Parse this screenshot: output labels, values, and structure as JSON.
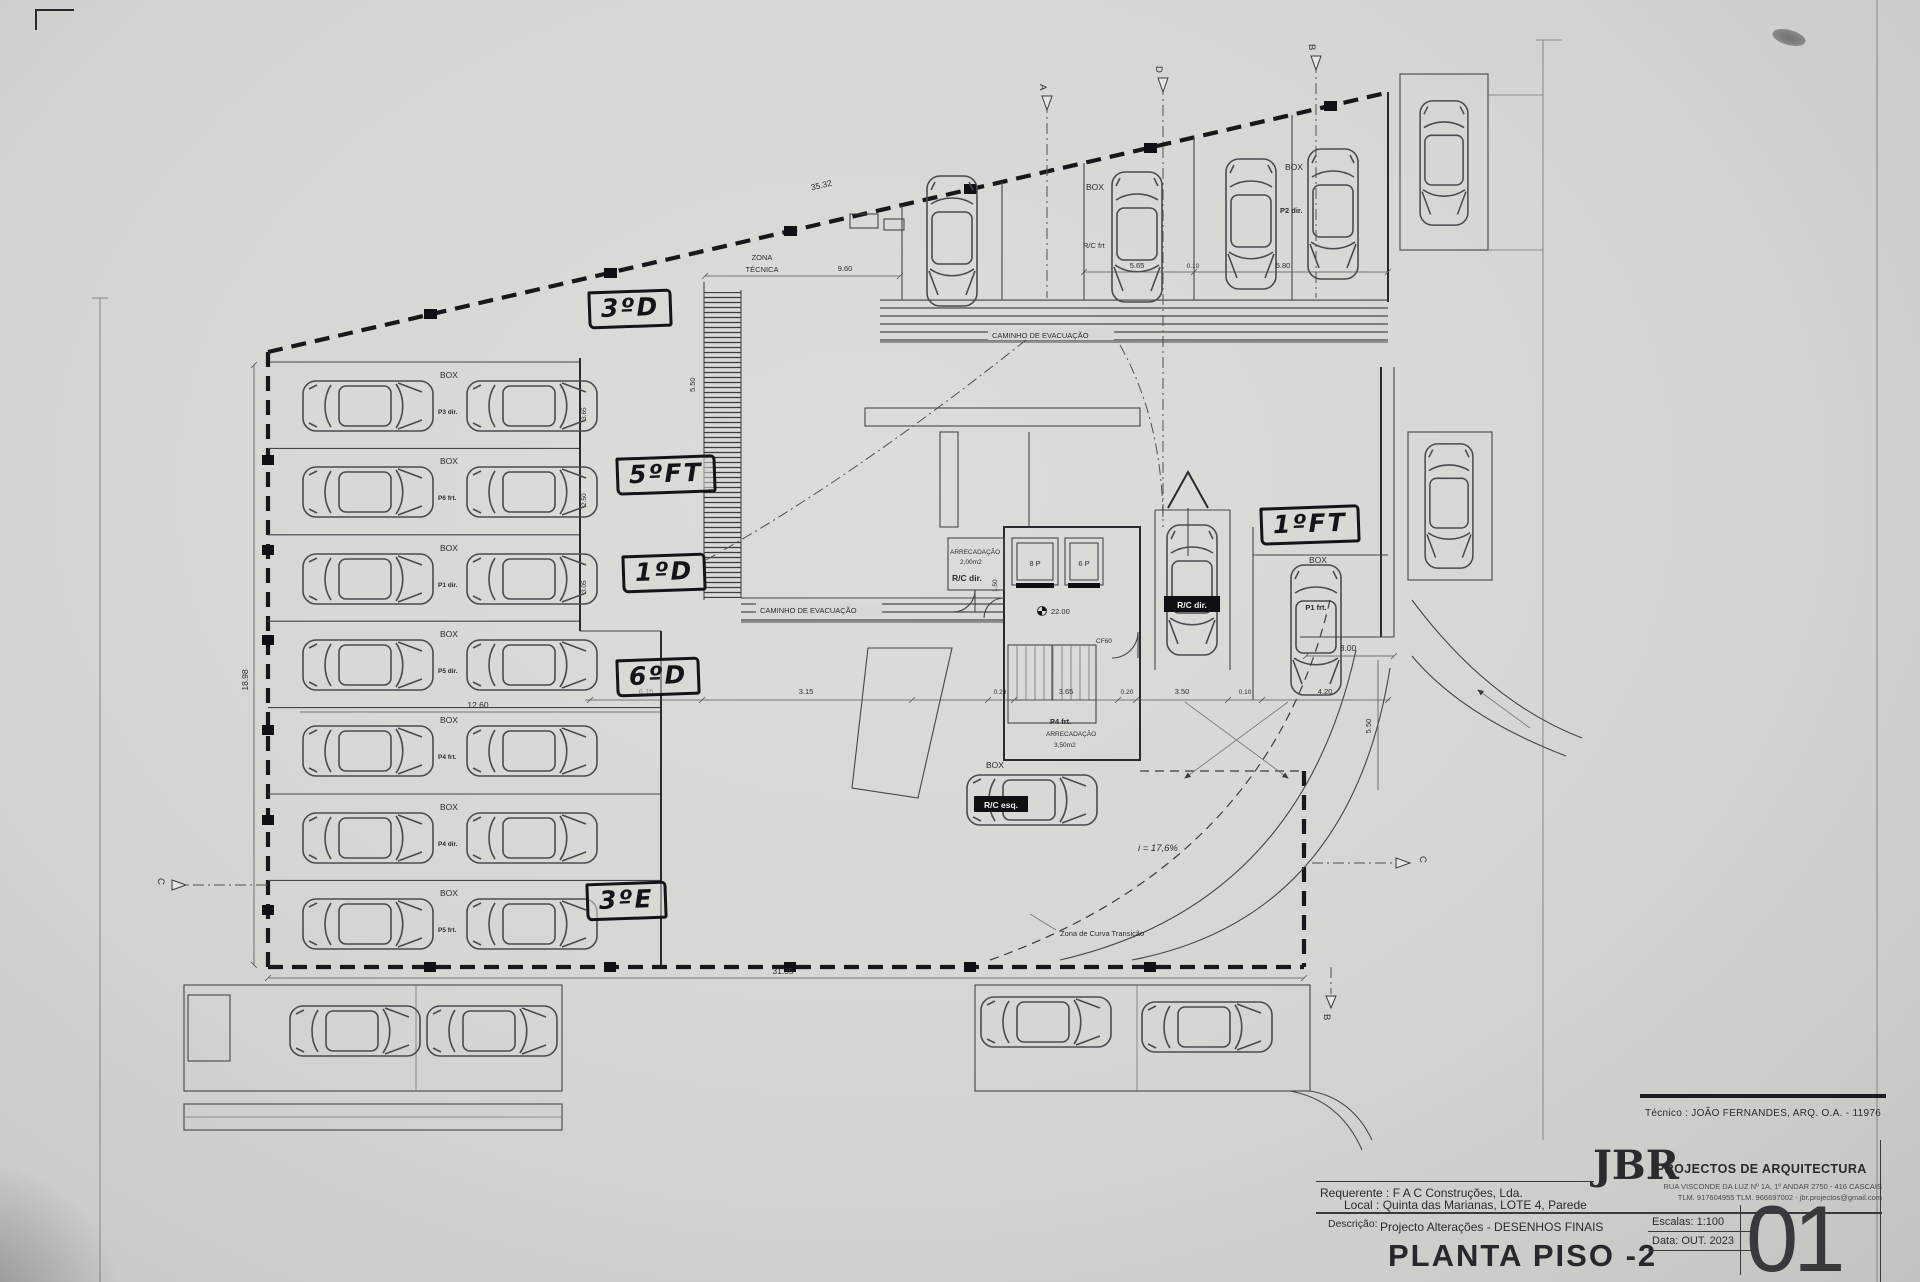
{
  "colors": {
    "paper": "#d9d8d5",
    "ink": "#2c2c30",
    "hand_ink": "#141418"
  },
  "title_block": {
    "tecnico": "Técnico : JOÃO FERNANDES, ARQ.  O.A. - 11976",
    "requerente": "Requerente : F A C  Construções, Lda.",
    "local": "Local : Quinta das Marianas, LOTE 4, Parede",
    "descricao_label": "Descrição:",
    "descricao": "Projecto Alterações - DESENHOS FINAIS",
    "drawing_title": "PLANTA PISO -2",
    "firm_initials": "JBR",
    "firm_name": "PROJECTOS DE ARQUITECTURA",
    "firm_address": "RUA VISCONDE DA LUZ Nº 1A, 1º ANDAR  2750 - 416  CASCAIS",
    "firm_contacts": "TLM. 917604955  TLM. 966697002 - jbr.projectos@gmail.com",
    "escala_label": "Escalas:  1:100",
    "data_label": "Data: OUT.  2023",
    "sheet_number": "01"
  },
  "handwritten": {
    "hw1": "3ºD",
    "hw2": "5ºFT",
    "hw3": "1ºD",
    "hw4": "6ºD",
    "hw5": "3ºE",
    "hw6": "1ºFT"
  },
  "labels": {
    "box": "BOX",
    "zona_tecnica_1": "ZONA",
    "zona_tecnica_2": "TÉCNICA",
    "caminho_evacuacao": "CAMINHO DE EVACUAÇÃO",
    "arrecadacao": "ARRECADAÇÃO",
    "arrecadacao_area_1": "2,00m2",
    "arrecadacao_area_2": "3,50m2",
    "rc_dir": "R/C dir.",
    "rc_esq": "R/C esq.",
    "rc_frt": "R/C frt",
    "p2_dir": "P2 dir.",
    "p1_frt": "P1 frt.",
    "p4_frt": "P4 frt.",
    "lift_8p": "8 P",
    "lift_6p": "6 P",
    "level": "22.00",
    "door_cf60": "CF60",
    "ramp_slope": "i = 17,6%",
    "curve_zone": "Zona de Curva Transição"
  },
  "stalls": {
    "row_codes": [
      "P3 dir.",
      "P6 frt.",
      "P1 dir.",
      "P5 dir.",
      "P4 frt.",
      "P4 dir.",
      "P5 frt."
    ],
    "row_dims": [
      "3.65",
      "2.50",
      "3.05"
    ]
  },
  "dimensions": {
    "top_edge": "35.32",
    "zona_span": "9.60",
    "bay_a": "5.65",
    "bay_gap": "0.10",
    "bay_b": "5.80",
    "left_span": "12.60",
    "left_height": "18.98",
    "ramp_width": "5.50",
    "core_side": "1.50",
    "right_height": "5.50",
    "right_offset": "3.00",
    "bottom_span": "31.35",
    "chain": [
      "6.15",
      "3.15",
      "0.29",
      "3.65",
      "0.20",
      "3.50",
      "0.10",
      "4.20"
    ]
  },
  "markers": {
    "a": "A",
    "d": "D",
    "b_top": "B",
    "c_left": "C",
    "c_right": "C",
    "b_bottom": "B"
  }
}
